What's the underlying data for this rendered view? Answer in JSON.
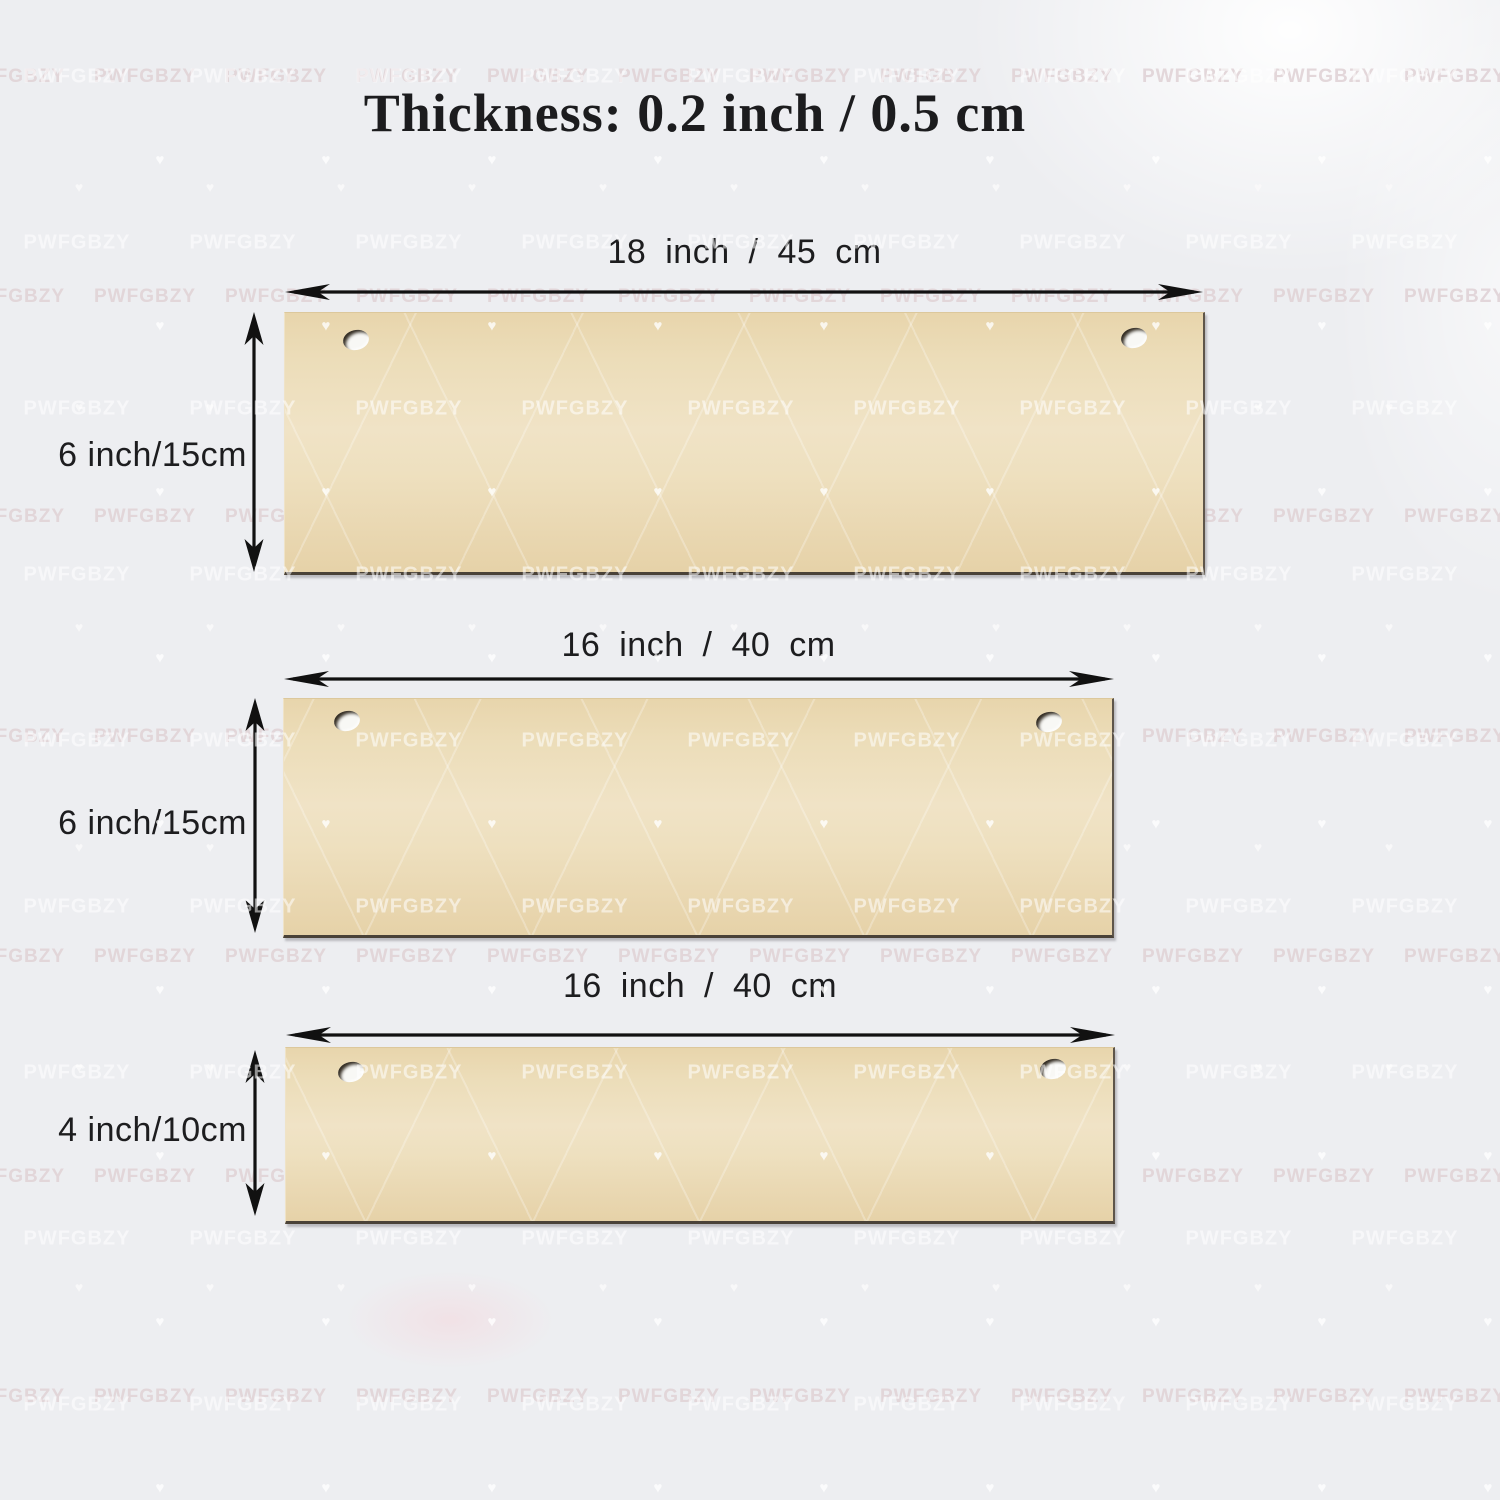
{
  "title": "Thickness: 0.2 inch / 0.5 cm",
  "watermark": {
    "text": "PWFGBZY",
    "heart_icon": "♥"
  },
  "planks": [
    {
      "width_label": "18 inch / 45 cm",
      "height_label": "6 inch/15cm"
    },
    {
      "width_label": "16 inch / 40 cm",
      "height_label": "6 inch/15cm"
    },
    {
      "width_label": "16 inch / 40 cm",
      "height_label": "4 inch/10cm"
    }
  ],
  "colors": {
    "background": "#edeef1",
    "plank": "#ecdcb8",
    "plank_edge": "#4a4238",
    "arrow": "#111111",
    "text": "#1d1d1f"
  }
}
